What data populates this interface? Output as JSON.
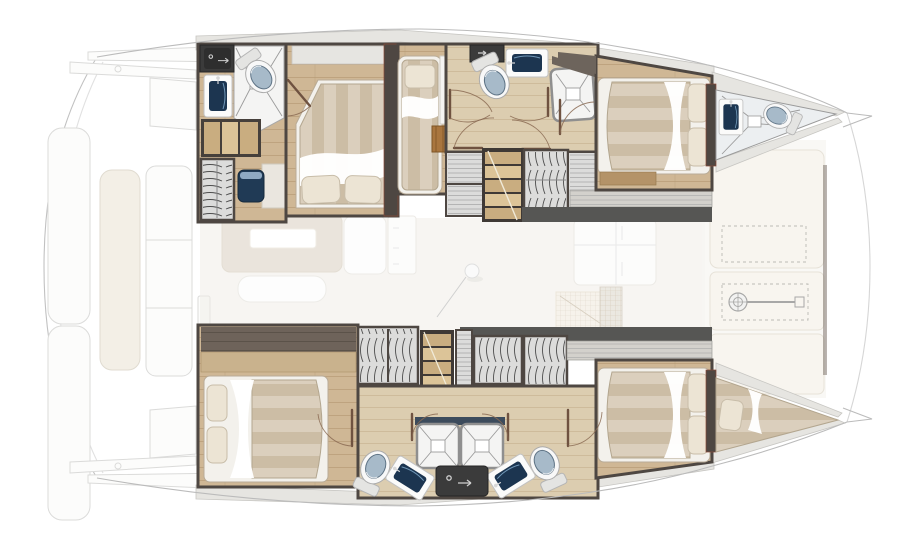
{
  "canvas": {
    "width": 900,
    "height": 535
  },
  "floorplan": {
    "type": "catamaran interior deck plan, top view, bow to the right",
    "orientation": "bow-right",
    "hulls": {
      "port": {
        "rooms": [
          "aft-head-with-shower",
          "owner-cabin",
          "single-berth",
          "mid-head",
          "companionway-stairs",
          "wardrobes",
          "bow-cabin",
          "forepeak-head"
        ]
      },
      "starboard": {
        "rooms": [
          "aft-cabin",
          "wardrobes",
          "companionway-stairs",
          "twin-heads-with-showers",
          "bow-cabin",
          "forepeak-berth"
        ]
      }
    },
    "bridgedeck": {
      "rooms": [
        "salon-dinette",
        "galley",
        "aft-cockpit",
        "foredeck-sunpads",
        "anchor-locker"
      ]
    },
    "fixtures": {
      "double_beds": 4,
      "single_beds": 2,
      "toilets": 5,
      "sinks": 6,
      "showers": 5,
      "wardrobes": 6,
      "staircases": 2,
      "mast": 1,
      "windlass": 1
    }
  },
  "palette": {
    "background": "#ffffff",
    "hull_outline": "#bbbbbb",
    "exterior_shape": "#fcfcfb",
    "exterior_line": "#d8d8d6",
    "cushion_cream": "#f2eee4",
    "deck_band": "#e6e5e1",
    "deck_edge": "#c7c6c2",
    "wall_dark": "#4e4742",
    "wall_mid": "#6d645c",
    "wall_redline": "#8a4a38",
    "wood_floor": "#cfb795",
    "wood_floor_light": "#dccdb0",
    "wood_plank_line": "#b2966f",
    "dark_wood_wall": "#6e635a",
    "step_wood": "#c9ad80",
    "step_wood_light": "#dcc498",
    "locker_orange": "#a9763f",
    "mattress_a": "#dbcfbd",
    "mattress_b": "#ccbda5",
    "pillow": "#ece4d4",
    "pillow_shadow": "#c8bda9",
    "bedframe_white": "#f3f1ec",
    "sheet_white": "#ffffff",
    "tile_white": "#f4f4f3",
    "tile_line": "#9b9b9b",
    "shower_border": "#8f8f8f",
    "toilet_white": "#f8f8f8",
    "toilet_lid": "#a7bac9",
    "toilet_dark": "#5e7385",
    "sink_navy": "#1c3550",
    "basin_blue": "#a9c3d6",
    "counter_white": "#fbfbfa",
    "appliance_dark": "#3b3b3b",
    "wardrobe_arc": "#4d4d4d",
    "hatch_line": "#a9a9a9",
    "salon_table": "#d9cfc0",
    "salon_floor": "#f1eee8",
    "salon_grid": "#c9b7a2",
    "door_line": "#6f5240",
    "door_arc": "#8a6a52"
  }
}
